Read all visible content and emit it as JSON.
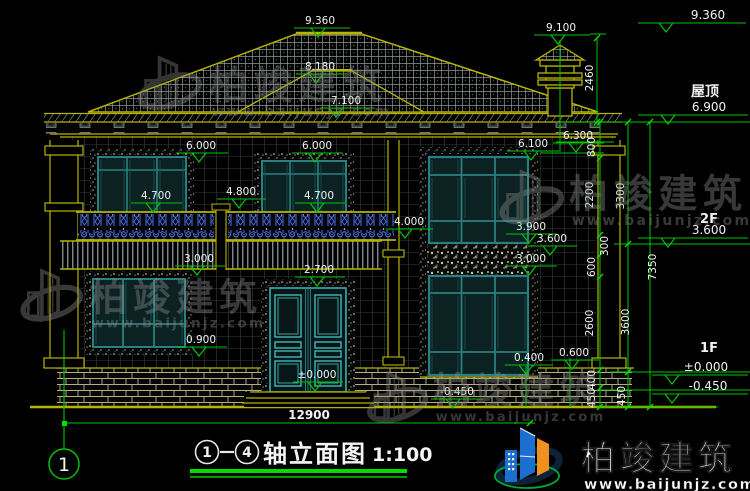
{
  "watermark": {
    "brand": "柏竣建筑",
    "url": "www.baijunjz.com"
  },
  "title": {
    "axis_start": "1",
    "axis_end": "4",
    "text": "轴立面图",
    "scale": "1:100"
  },
  "axis_bubble": {
    "label": "1"
  },
  "ground_dimension": "12900",
  "annotations": {
    "levels": [
      {
        "t": "9.360",
        "x": 320,
        "y": 24,
        "x1": 294,
        "x2": 350,
        "ax": 318
      },
      {
        "t": "8.180",
        "x": 320,
        "y": 70,
        "x1": 296,
        "x2": 346,
        "ax": 316
      },
      {
        "t": "7.100",
        "x": 346,
        "y": 104,
        "x1": 320,
        "x2": 374,
        "ax": 336
      },
      {
        "t": "9.100",
        "x": 561,
        "y": 31,
        "x1": 534,
        "x2": 590,
        "ax": 558
      },
      {
        "t": "6.000",
        "x": 201,
        "y": 149,
        "x1": 176,
        "x2": 228,
        "ax": 199
      },
      {
        "t": "6.000",
        "x": 317,
        "y": 149,
        "x1": 292,
        "x2": 343,
        "ax": 315
      },
      {
        "t": "6.100",
        "x": 533,
        "y": 147,
        "x1": 507,
        "x2": 559,
        "ax": 531
      },
      {
        "t": "6.300",
        "x": 578,
        "y": 139,
        "x1": 553,
        "x2": 604,
        "ax": 576
      },
      {
        "t": "4.700",
        "x": 156,
        "y": 199,
        "x1": 131,
        "x2": 182,
        "ax": 153
      },
      {
        "t": "4.800",
        "x": 241,
        "y": 195,
        "x1": 217,
        "x2": 266,
        "ax": 239
      },
      {
        "t": "4.700",
        "x": 319,
        "y": 199,
        "x1": 295,
        "x2": 345,
        "ax": 317
      },
      {
        "t": "4.000",
        "x": 409,
        "y": 225,
        "x1": 386,
        "x2": 433,
        "ax": 405
      },
      {
        "t": "3.900",
        "x": 531,
        "y": 230,
        "x1": 506,
        "x2": 557,
        "ax": 529
      },
      {
        "t": "3.600",
        "x": 552,
        "y": 242,
        "x1": 528,
        "x2": 577,
        "ax": 550
      },
      {
        "t": "3.000",
        "x": 531,
        "y": 262,
        "x1": 506,
        "x2": 557,
        "ax": 529
      },
      {
        "t": "3.000",
        "x": 199,
        "y": 262,
        "x1": 175,
        "x2": 225,
        "ax": 197
      },
      {
        "t": "2.700",
        "x": 319,
        "y": 273,
        "x1": 295,
        "x2": 345,
        "ax": 317
      },
      {
        "t": "0.900",
        "x": 201,
        "y": 343,
        "x1": 177,
        "x2": 227,
        "ax": 199
      },
      {
        "t": "0.400",
        "x": 529,
        "y": 361,
        "x1": 505,
        "x2": 553,
        "ax": 526
      },
      {
        "t": "0.600",
        "x": 574,
        "y": 356,
        "x1": 551,
        "x2": 599,
        "ax": 572
      },
      {
        "t": "-0.450",
        "x": 457,
        "y": 395,
        "x1": 431,
        "x2": 483,
        "ax": 453
      },
      {
        "t": "±0.000",
        "x": 317,
        "y": 378,
        "x1": 293,
        "x2": 343,
        "ax": 315
      },
      {
        "t": "9.360",
        "x": 708,
        "y": 19,
        "x1": 638,
        "x2": 746,
        "ax": 666,
        "s": 12
      },
      {
        "t": "6.900",
        "x": 709,
        "y": 111,
        "x1": 638,
        "x2": 748,
        "ax": 668,
        "s": 12
      },
      {
        "t": "3.600",
        "x": 709,
        "y": 234,
        "x1": 638,
        "x2": 748,
        "ax": 668,
        "s": 12
      },
      {
        "t": "±0.000",
        "x": 706,
        "y": 371,
        "x1": 652,
        "x2": 748,
        "ax": 672,
        "s": 12
      },
      {
        "t": "-0.450",
        "x": 708,
        "y": 390,
        "x1": 652,
        "x2": 748,
        "ax": 672,
        "s": 12
      }
    ],
    "vdims": [
      {
        "t": "2460",
        "x": 593,
        "y": 78
      },
      {
        "t": "800",
        "x": 595,
        "y": 147
      },
      {
        "t": "2200",
        "x": 593,
        "y": 195
      },
      {
        "t": "3300",
        "x": 624,
        "y": 196
      },
      {
        "t": "300",
        "x": 608,
        "y": 246
      },
      {
        "t": "600",
        "x": 595,
        "y": 267
      },
      {
        "t": "7350",
        "x": 656,
        "y": 267
      },
      {
        "t": "2600",
        "x": 593,
        "y": 323
      },
      {
        "t": "3600",
        "x": 629,
        "y": 322
      },
      {
        "t": "400",
        "x": 595,
        "y": 380
      },
      {
        "t": "450",
        "x": 595,
        "y": 398
      },
      {
        "t": "450",
        "x": 625,
        "y": 396
      }
    ],
    "texts": [
      {
        "t": "12900",
        "x": 309,
        "y": 419,
        "s": 12
      },
      {
        "t": "屋顶",
        "x": 705,
        "y": 96,
        "s": 14
      },
      {
        "t": "2F",
        "x": 709,
        "y": 223,
        "s": 13
      },
      {
        "t": "1F",
        "x": 709,
        "y": 352,
        "s": 13
      }
    ]
  },
  "colors": {
    "dim_green": "#00c400",
    "cad_yellow": "#b8b400",
    "text_white": "#eff3ef",
    "frame_teal": "#2a8080",
    "door_teal": "#45c5c5",
    "railing_blue": "#4a6ae0",
    "logo_blue": "#1a6fd0",
    "logo_orange": "#f09020",
    "underline_green": "#00dd00"
  }
}
